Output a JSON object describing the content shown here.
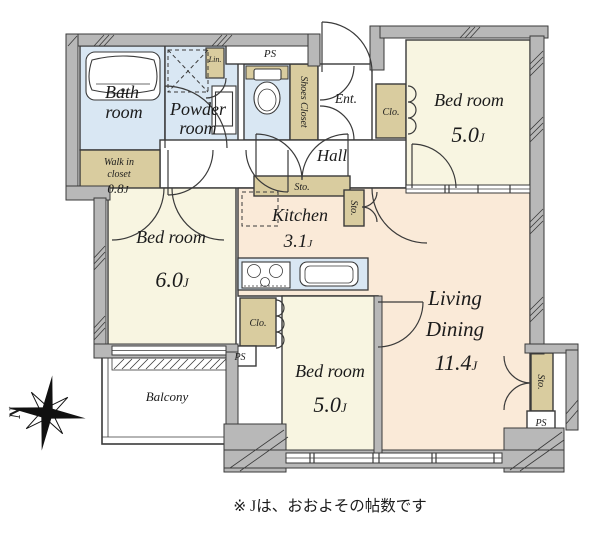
{
  "note": "※ Jは、おおよその帖数です",
  "unit_suffix": "J",
  "compass": {
    "north_label": "N"
  },
  "rooms": {
    "bath": {
      "lines": [
        "Bath",
        "room"
      ]
    },
    "powder": {
      "lines": [
        "Powder",
        "room"
      ]
    },
    "walk_in_closet": {
      "lines": [
        "Walk in",
        "closet"
      ],
      "size": "0.8"
    },
    "hall": {
      "label": "Hall"
    },
    "entrance": {
      "label": "Ent."
    },
    "shoes_closet": {
      "label": "Shoes Closet"
    },
    "bedroom_top_right": {
      "label": "Bed room",
      "size": "5.0"
    },
    "bedroom_left": {
      "label": "Bed room",
      "size": "6.0"
    },
    "bedroom_bottom": {
      "label": "Bed room",
      "size": "5.0"
    },
    "kitchen": {
      "label": "Kitchen",
      "size": "3.1"
    },
    "living_dining": {
      "lines": [
        "Living",
        "Dining"
      ],
      "size": "11.4"
    },
    "balcony": {
      "label": "Balcony"
    }
  },
  "storage_labels": {
    "closet": "Clo.",
    "storage": "Sto.",
    "linen": "Lin.",
    "pipe_space": "PS"
  },
  "colors": {
    "room_cream": "#f8f5e1",
    "room_peach": "#faead8",
    "wet_blue": "#d9e7f3",
    "storage_tan": "#d9cc9f",
    "wall_gray": "#b8b8b8",
    "line": "#3a3a3a"
  }
}
